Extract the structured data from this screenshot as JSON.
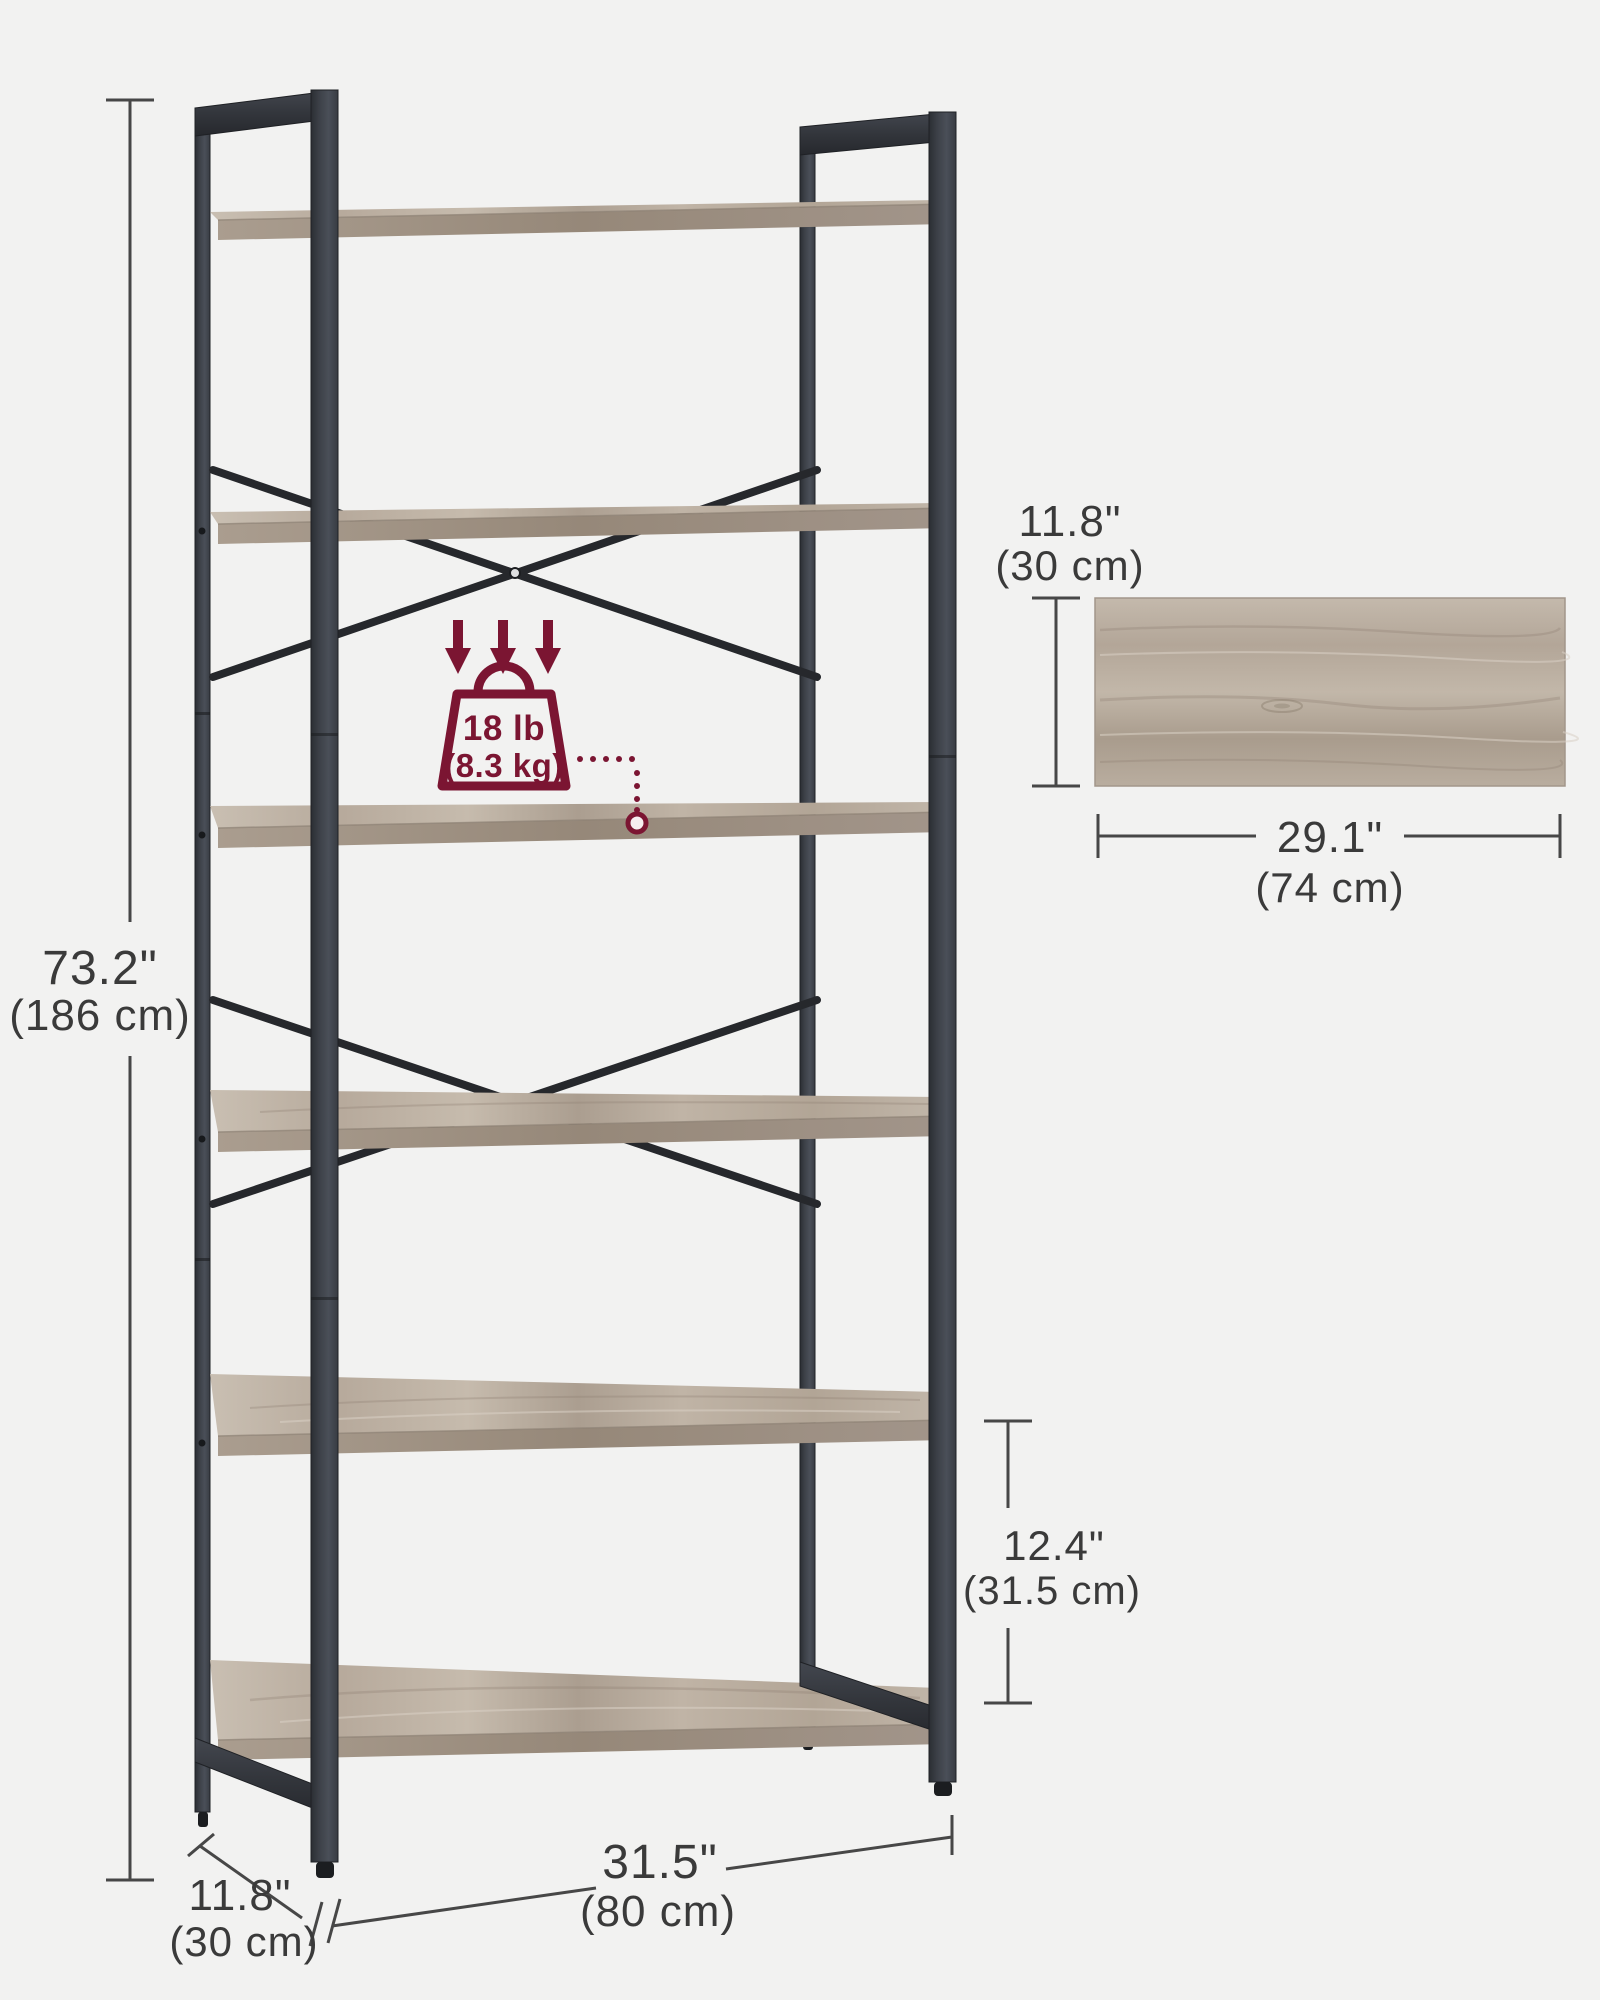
{
  "page": {
    "background": "#f2f2f1"
  },
  "palette": {
    "frame_metal": "#33373d",
    "frame_dark": "#1f2124",
    "brace": "#26282c",
    "wood": "#bcb0a3",
    "wood_shadow": "#9d9083",
    "dimension_ink": "#3a3a3a",
    "accent_burgundy": "#7b1532",
    "background": "#f2f2f1"
  },
  "bookshelf": {
    "tiers": 6
  },
  "dimensions": {
    "height": {
      "inches": "73.2\"",
      "centimeters": "(186 cm)"
    },
    "width": {
      "inches": "31.5\"",
      "centimeters": "(80 cm)"
    },
    "depth": {
      "inches": "11.8\"",
      "centimeters": "(30 cm)"
    },
    "tier_spacing": {
      "inches": "12.4\"",
      "centimeters": "(31.5 cm)"
    },
    "shelf_panel_depth": {
      "inches": "11.8\"",
      "centimeters": "(30 cm)"
    },
    "shelf_panel_width": {
      "inches": "29.1\"",
      "centimeters": "(74 cm)"
    }
  },
  "load_capacity": {
    "pounds": "18 lb",
    "kilograms": "(8.3 kg)"
  }
}
